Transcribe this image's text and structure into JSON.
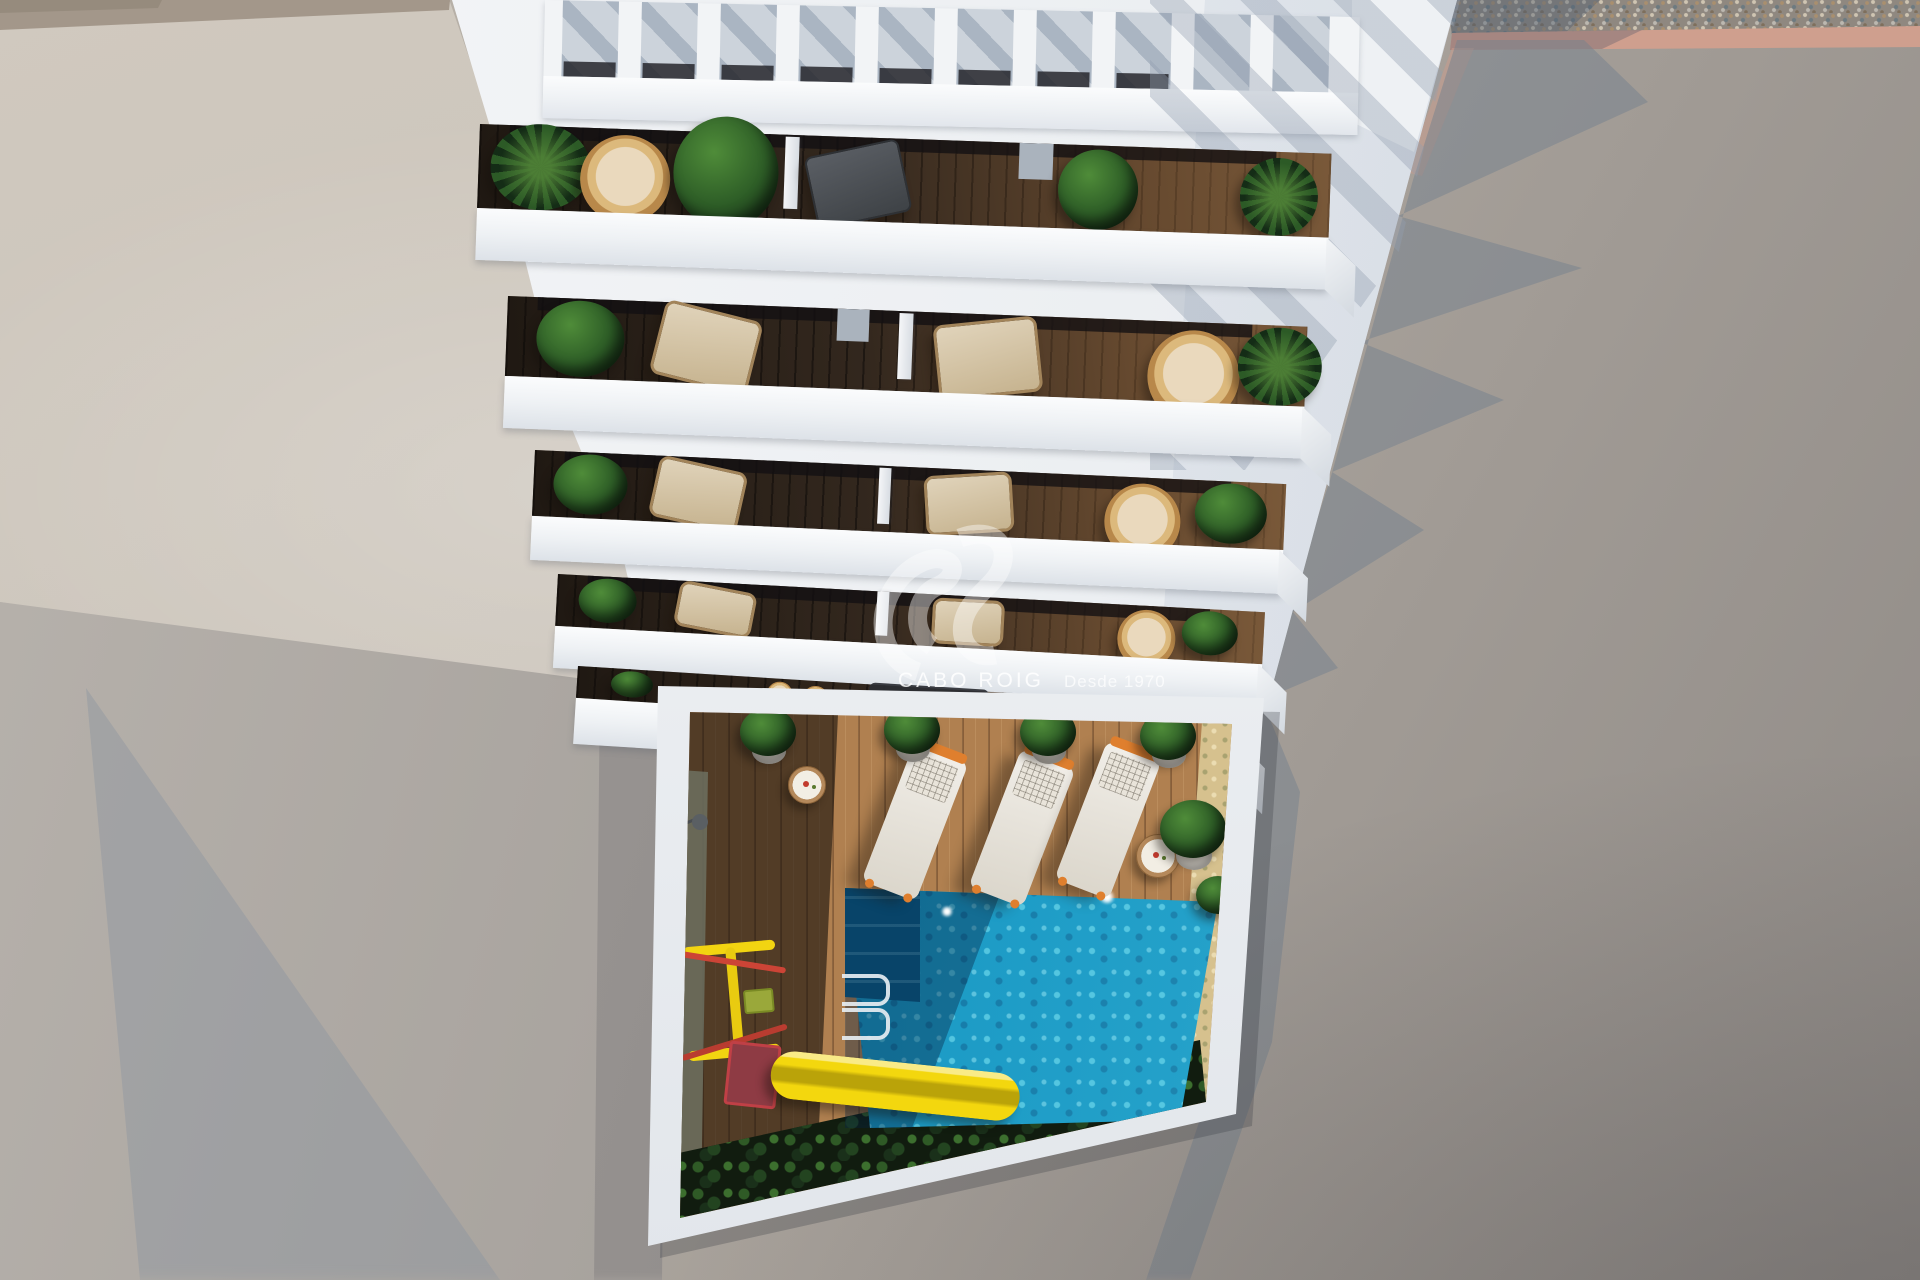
{
  "scene": {
    "kind": "aerial 3d architectural render, top-down view",
    "watermark": {
      "brand": "CABO ROIG",
      "tagline": "Desde 1970",
      "logo": "double-swoosh-monogram"
    },
    "building": {
      "visible_floors": 5,
      "pergola_slat_gaps": 10,
      "balconies_per_floor": 2
    },
    "courtyard": {
      "sun_loungers": 3,
      "side_tables": 2,
      "potted_plants": 6,
      "pool": "rectangular turquoise pool with corner steps and ladder",
      "playground": "yellow slide with red platform and swing frame",
      "hedge": "dark green hedge along lower wall"
    },
    "palette": {
      "building_white": "#eef0f3",
      "pool_turquoise": "#1495c2",
      "deck_wood_lit": "#b08050",
      "balcony_deck_dark": "#3a2d22",
      "ground_gray": "#a9a29b",
      "side_wall_beige": "#cbc4ba",
      "gravel_gray": "#8f8880",
      "curb_salmon": "#cf9f8e",
      "hedge_green": "#1d3a1d",
      "slide_yellow": "#f3d70e",
      "slide_red": "#8e3b44",
      "lounger_accent_orange": "#df7f2e",
      "shadow_blue_gray": "#78828f"
    }
  }
}
